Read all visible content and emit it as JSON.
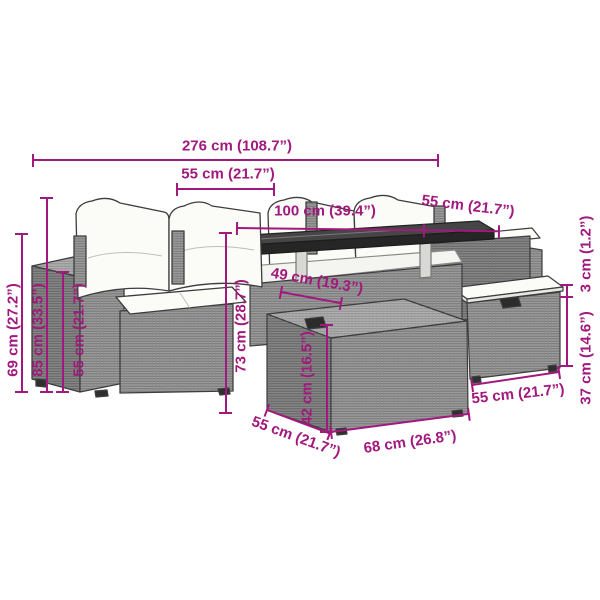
{
  "page": {
    "width": 600,
    "height": 600,
    "background": "#ffffff"
  },
  "style": {
    "dimension_color": "#a2197d"
  },
  "illustration": {
    "subject": "grey-poly-rattan-garden-lounge-set",
    "parts": [
      "left-sofa",
      "left-armrest",
      "back-cushions",
      "seat-cushion",
      "corner-sofa-back-cushions",
      "dining-table",
      "table-top",
      "storage-ottoman",
      "right-bench",
      "right-stool",
      "stool-cushion"
    ]
  },
  "measurements": {
    "total_width": {
      "label": "276 cm (108.7”)"
    },
    "left_seat_width": {
      "label": "55 cm (21.7”)"
    },
    "table_length": {
      "label": "100 cm (39.4”)"
    },
    "right_seat_width": {
      "label": "55 cm (21.7”)"
    },
    "armrest_height": {
      "label": "69 cm (27.2”)"
    },
    "backrest_height": {
      "label": "85 cm (33.5”)"
    },
    "armrest_top_height": {
      "label": "55 cm (21.7”)"
    },
    "sofa_height": {
      "label": "73 cm (28.7”)"
    },
    "table_depth": {
      "label": "49 cm (19.3”)"
    },
    "ottoman_height": {
      "label": "42 cm (16.5”)"
    },
    "ottoman_depth": {
      "label": "55 cm (21.7”)"
    },
    "ottoman_width": {
      "label": "68 cm (26.8”)"
    },
    "stool_width": {
      "label": "55 cm (21.7”)"
    },
    "stool_height": {
      "label": "37 cm (14.6”)"
    },
    "stool_cushion_thickness": {
      "label": "3 cm (1.2”)"
    }
  }
}
